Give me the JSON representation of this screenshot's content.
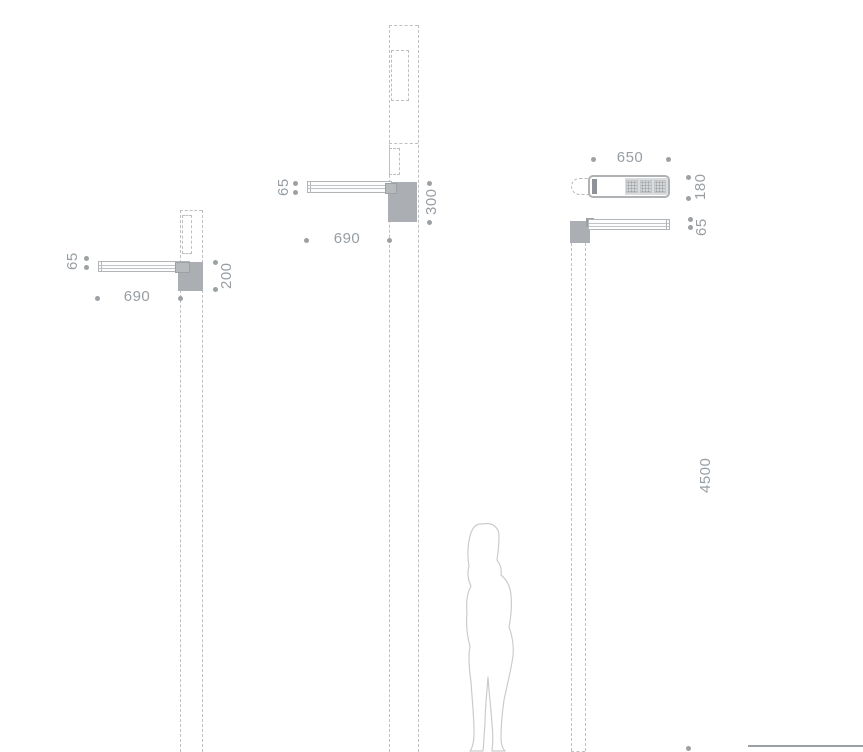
{
  "colors": {
    "construction_line": "#bcc0c2",
    "housing_gray": "#abaeb2",
    "brand_bar_gray": "#8d9398",
    "dimension_text": "#979ea4",
    "dimension_dot": "#9ba1a5",
    "silhouette_outline": "#c9cccd",
    "ground_line": "#9aa0a4"
  },
  "left_view": {
    "arm_thickness": "65",
    "arm_length": "690",
    "housing_height": "200"
  },
  "middle_view": {
    "arm_thickness": "65",
    "arm_length": "690",
    "housing_height": "300"
  },
  "right_view": {
    "top_length": "650",
    "top_width": "180",
    "arm_thickness": "65",
    "mounting_height": "4500"
  }
}
